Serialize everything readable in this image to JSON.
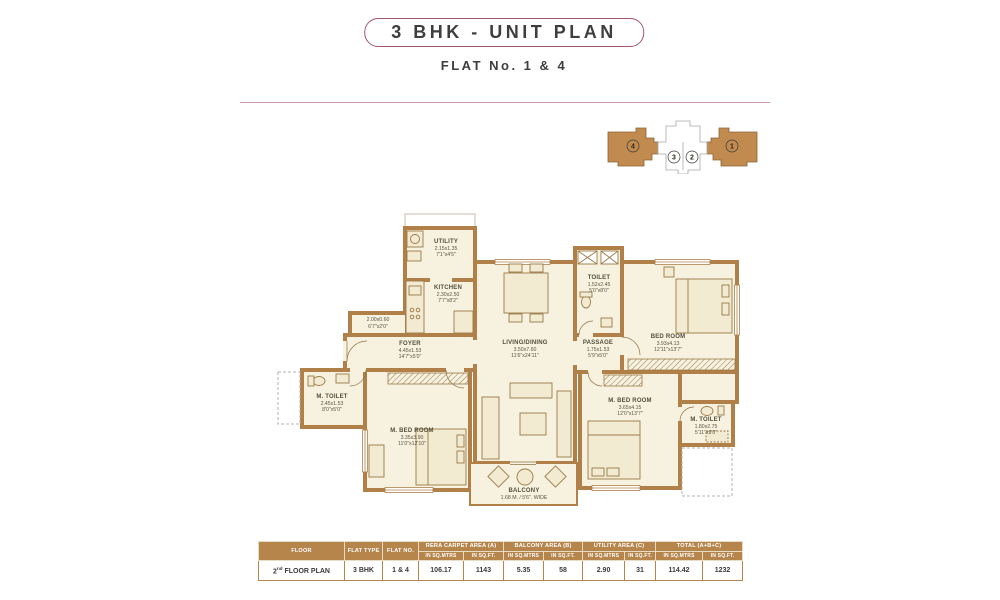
{
  "header": {
    "title": "3 BHK - UNIT PLAN",
    "subtitle": "FLAT No. 1 & 4"
  },
  "key_plan": {
    "flats": [
      "4",
      "3",
      "2",
      "1"
    ],
    "highlight_color": "#c18b50"
  },
  "plan": {
    "wall_color": "#b08048",
    "floor_color": "#f7f1df",
    "rooms": [
      {
        "name": "UTILITY",
        "l1": "2.15x1.35",
        "l2": "7'1\"x4'5\""
      },
      {
        "name": "KITCHEN",
        "l1": "2.30x2.50",
        "l2": "7'7\"x8'2\""
      },
      {
        "name": "",
        "l1": "2.00x0.60",
        "l2": "6'7\"x2'0\""
      },
      {
        "name": "FOYER",
        "l1": "4.45x1.53",
        "l2": "14'7\"x5'0\""
      },
      {
        "name": "M. TOILET",
        "l1": "2.45x1.53",
        "l2": "8'0\"x5'0\""
      },
      {
        "name": "M. BED ROOM",
        "l1": "3.35x3.90",
        "l2": "11'0\"x12'10\""
      },
      {
        "name": "LIVING/DINING",
        "l1": "3.50x7.60",
        "l2": "11'6\"x24'11\""
      },
      {
        "name": "PASSAGE",
        "l1": "1.75x1.53",
        "l2": "5'9\"x5'0\""
      },
      {
        "name": "TOILET",
        "l1": "1.52x2.45",
        "l2": "5'0\"x8'0\""
      },
      {
        "name": "BED ROOM",
        "l1": "3.93x4.13",
        "l2": "12'11\"x13'7\""
      },
      {
        "name": "M. BED ROOM",
        "l1": "3.65x4.15",
        "l2": "12'0\"x13'7\""
      },
      {
        "name": "M. TOILET",
        "l1": "1.80x2.75",
        "l2": "5'11\"x9'0\""
      },
      {
        "name": "BALCONY",
        "l1": "1.68 M. / 5'6\". WIDE",
        "l2": ""
      }
    ]
  },
  "table": {
    "headers": {
      "floor": "FLOOR",
      "flat_type": "FLAT TYPE",
      "flat_no": "FLAT NO.",
      "groups": [
        "RERA CARPET AREA (A)",
        "BALCONY AREA (B)",
        "UTILITY AREA (C)",
        "TOTAL (A+B+C)"
      ],
      "sub_mtrs": "IN SQ.MTRS",
      "sub_ft": "IN SQ.FT."
    },
    "row": {
      "floor_num": "2",
      "floor_sup": "nd",
      "floor_label": "FLOOR PLAN",
      "flat_type": "3 BHK",
      "flat_no": "1 & 4",
      "values": [
        "106.17",
        "1143",
        "5.35",
        "58",
        "2.90",
        "31",
        "114.42",
        "1232"
      ]
    }
  }
}
